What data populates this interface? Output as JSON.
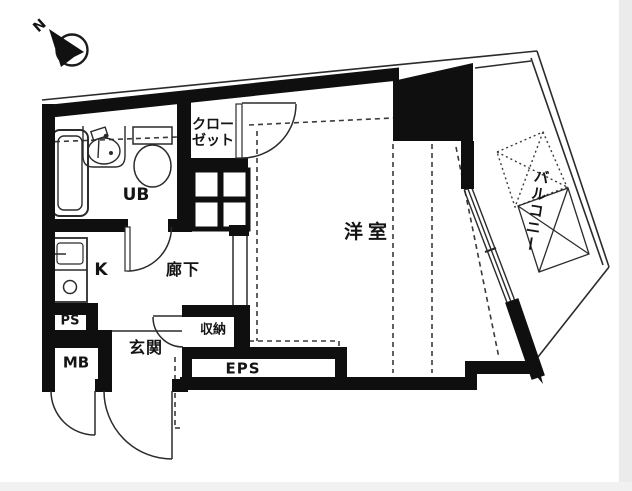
{
  "compass": {
    "north_label": "N"
  },
  "rooms": {
    "western_room": "洋室",
    "closet": "クローゼット",
    "unit_bath": "UB",
    "kitchen": "K",
    "hallway": "廊下",
    "pipe_space": "PS",
    "meter_box": "MB",
    "entrance": "玄関",
    "storage": "収納",
    "eps": "EPS",
    "balcony": "バルコニー"
  },
  "colors": {
    "wall": "#0f0f0f",
    "thin_line": "#2b2b2b",
    "background": "#ffffff"
  }
}
